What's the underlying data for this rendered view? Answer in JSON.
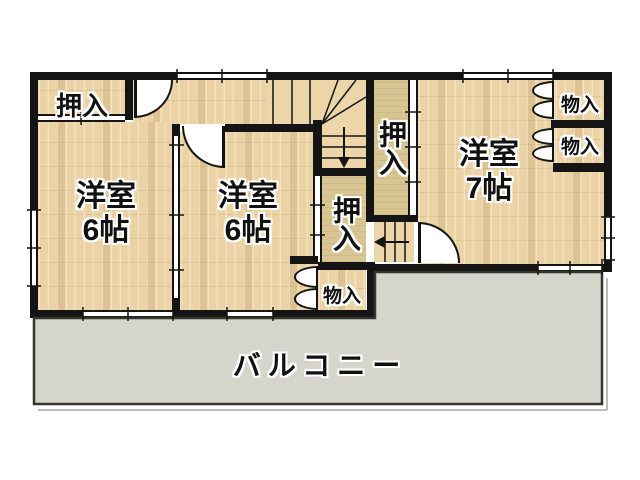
{
  "plan": {
    "rooms": {
      "left": {
        "type": "洋室",
        "size": "6帖"
      },
      "middle": {
        "type": "洋室",
        "size": "6帖"
      },
      "right": {
        "type": "洋室",
        "size": "7帖"
      }
    },
    "closets": {
      "top_left": "押入",
      "stair_side": "押入",
      "middle": "押入",
      "storage_middle": "物入",
      "storage_right_top": "物入",
      "storage_right_bottom": "物入"
    },
    "balcony_label": "バルコニー",
    "colors": {
      "wall": "#141414",
      "wood_floor": "#ebd3a5",
      "closet_floor": "#d8c591",
      "stair_floor": "#ecd6a9",
      "balcony": "#d5d5cb",
      "background": "#ffffff"
    }
  }
}
